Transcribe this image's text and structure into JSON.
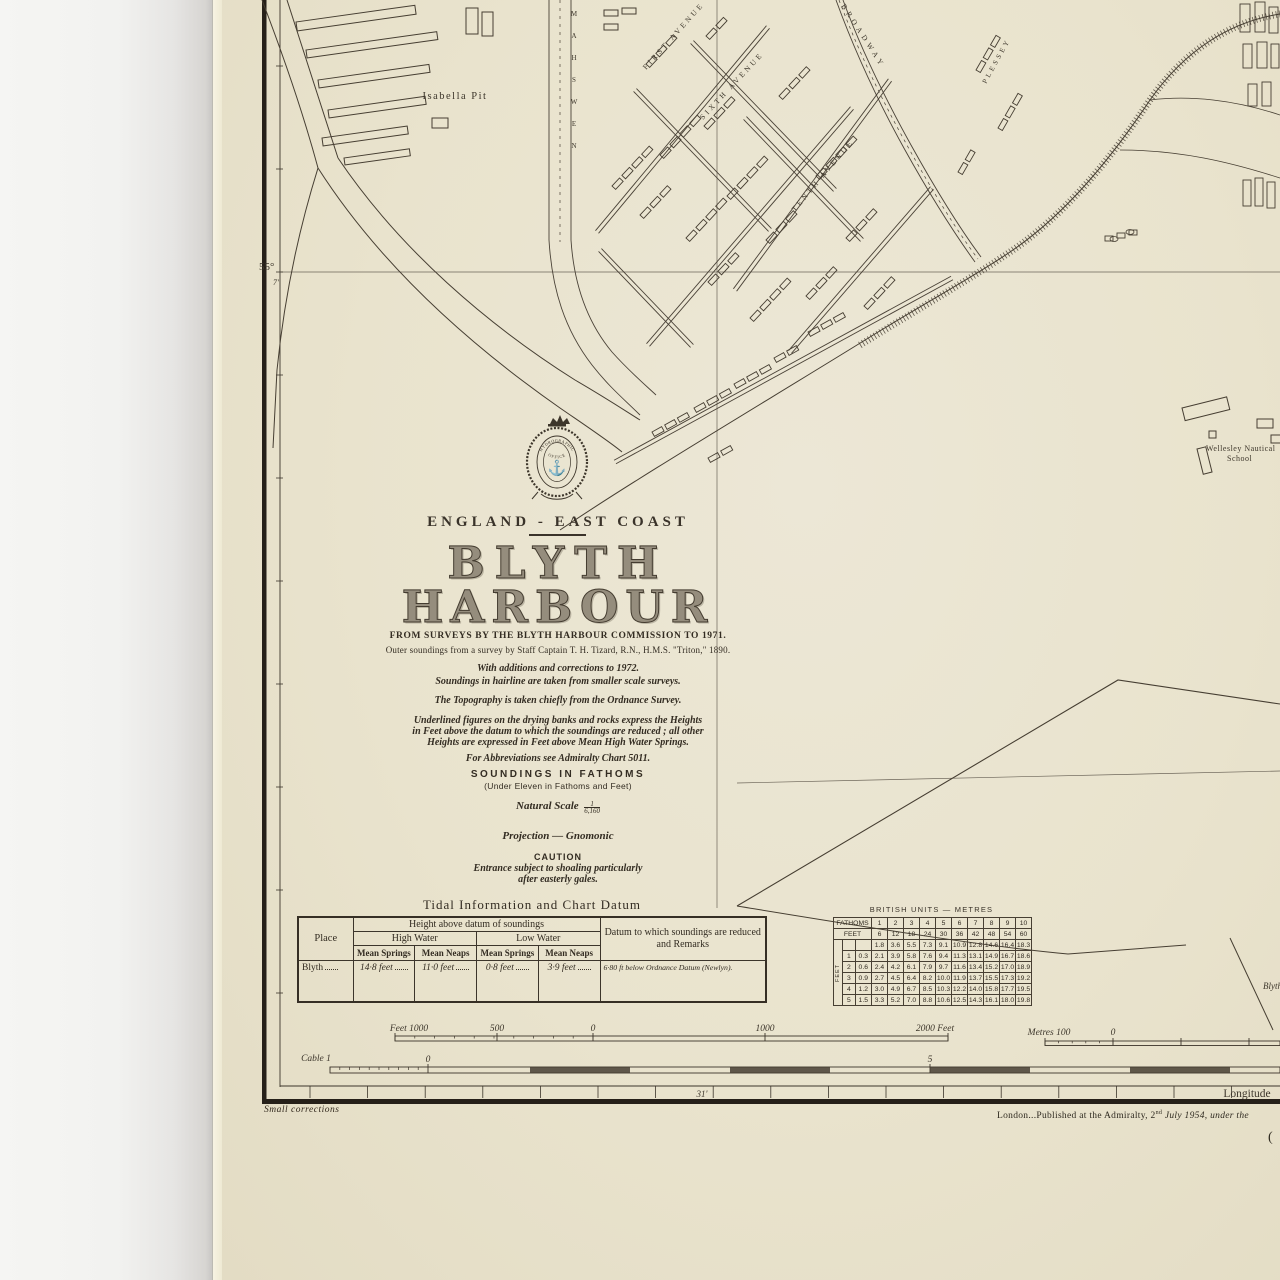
{
  "chart": {
    "region_label": "ENGLAND - EAST COAST",
    "title_line1": "BLYTH",
    "title_line2": "HARBOUR",
    "source_line1": "FROM SURVEYS BY THE BLYTH HARBOUR COMMISSION TO 1971.",
    "source_line2": "Outer soundings from a survey by Staff Captain T. H. Tizard, R.N., H.M.S. \"Triton,\" 1890.",
    "corrections_line1": "With additions and corrections to 1972.",
    "corrections_line2": "Soundings in hairline are taken from smaller scale surveys.",
    "topography_note": "The Topography is taken chiefly from the Ordnance Survey.",
    "heights_note_l1": "Underlined figures on the drying banks and rocks express the Heights",
    "heights_note_l2": "in Feet above the datum to which the soundings are reduced ; all other",
    "heights_note_l3": "Heights are expressed in Feet above Mean High Water Springs.",
    "abbreviations_note": "For Abbreviations see Admiralty Chart 5011.",
    "soundings_heading": "SOUNDINGS  IN  FATHOMS",
    "soundings_sub": "(Under Eleven in Fathoms and Feet)",
    "natural_scale_label": "Natural Scale",
    "natural_scale_num": "1",
    "natural_scale_den": "6,160",
    "projection": "Projection — Gnomonic",
    "caution_heading": "CAUTION",
    "caution_l1": "Entrance subject to shoaling particularly",
    "caution_l2": "after easterly gales.",
    "crest_text_top": "HYDROGRAPHIC",
    "crest_text_bottom": "OFFICE",
    "crest_anchor": "⚓"
  },
  "map_labels": {
    "isabella_pit": "Isabella Pit",
    "newsham": "NEWSHAM",
    "plessey": "PLESSEY",
    "first_avenue": "FIRST AVENUE",
    "sixth_avenue": "SIXTH AVENUE",
    "tenth_avenue": "TENTH AVENUE",
    "broadway": "BROADWAY",
    "wellesley_l1": "Wellesley Nautical",
    "wellesley_l2": "School",
    "blyth_partial": "Blyth",
    "latitude_deg": "55°",
    "latitude_min": "7'",
    "longitude_tick": "31'",
    "longitude_label": "Longitude"
  },
  "tidal_table": {
    "title": "Tidal Information and Chart Datum",
    "col_place": "Place",
    "col_height_group": "Height above datum of soundings",
    "col_high_water": "High Water",
    "col_low_water": "Low Water",
    "col_mean_springs": "Mean Springs",
    "col_mean_neaps": "Mean Neaps",
    "col_datum": "Datum to which soundings are reduced and Remarks",
    "rows": [
      {
        "place": "Blyth",
        "hw_springs": "14·8 feet",
        "hw_neaps": "11·0 feet",
        "lw_springs": "0·8 feet",
        "lw_neaps": "3·9 feet",
        "datum": "6·80 ft below Ordnance Datum (Newlyn)."
      }
    ]
  },
  "conversion_table": {
    "title": "BRITISH UNITS — METRES",
    "fathoms_label": "FATHOMS",
    "feet_label": "FEET",
    "side_label": "FEET",
    "fathoms": [
      "1",
      "2",
      "3",
      "4",
      "5",
      "6",
      "7",
      "8",
      "9",
      "10"
    ],
    "fathoms_feet": [
      "6",
      "12",
      "18",
      "24",
      "30",
      "36",
      "42",
      "48",
      "54",
      "60"
    ],
    "rows": [
      {
        "feet": "",
        "feet_m": "",
        "values": [
          "1.8",
          "3.6",
          "5.5",
          "7.3",
          "9.1",
          "10.9",
          "12.8",
          "14.6",
          "16.4",
          "18.3"
        ]
      },
      {
        "feet": "1",
        "feet_m": "0.3",
        "values": [
          "2.1",
          "3.9",
          "5.8",
          "7.6",
          "9.4",
          "11.3",
          "13.1",
          "14.9",
          "16.7",
          "18.6"
        ]
      },
      {
        "feet": "2",
        "feet_m": "0.6",
        "values": [
          "2.4",
          "4.2",
          "6.1",
          "7.9",
          "9.7",
          "11.6",
          "13.4",
          "15.2",
          "17.0",
          "18.9"
        ]
      },
      {
        "feet": "3",
        "feet_m": "0.9",
        "values": [
          "2.7",
          "4.5",
          "6.4",
          "8.2",
          "10.0",
          "11.9",
          "13.7",
          "15.5",
          "17.3",
          "19.2"
        ]
      },
      {
        "feet": "4",
        "feet_m": "1.2",
        "values": [
          "3.0",
          "4.9",
          "6.7",
          "8.5",
          "10.3",
          "12.2",
          "14.0",
          "15.8",
          "17.7",
          "19.5"
        ]
      },
      {
        "feet": "5",
        "feet_m": "1.5",
        "values": [
          "3.3",
          "5.2",
          "7.0",
          "8.8",
          "10.6",
          "12.5",
          "14.3",
          "16.1",
          "18.0",
          "19.8"
        ]
      }
    ]
  },
  "scale_bars": {
    "feet_label_left": "Feet 1000",
    "feet_500": "500",
    "feet_0": "0",
    "feet_1000r": "1000",
    "feet_2000": "2000 Feet",
    "metres_label": "Metres 100",
    "metres_0": "0",
    "cable_label": "Cable 1",
    "cable_0": "0",
    "cable_5": "5"
  },
  "footer": {
    "small_corrections": "Small corrections",
    "publication_pre": "London...Published at the Admiralty, 2",
    "publication_sup": "nd",
    "publication_post": " July 1954, under the",
    "paren": "("
  },
  "colors": {
    "paper": "#e9e3cd",
    "ink": "#3a332a",
    "wall": "#f2f2f0",
    "title_fill": "#958d7d"
  }
}
